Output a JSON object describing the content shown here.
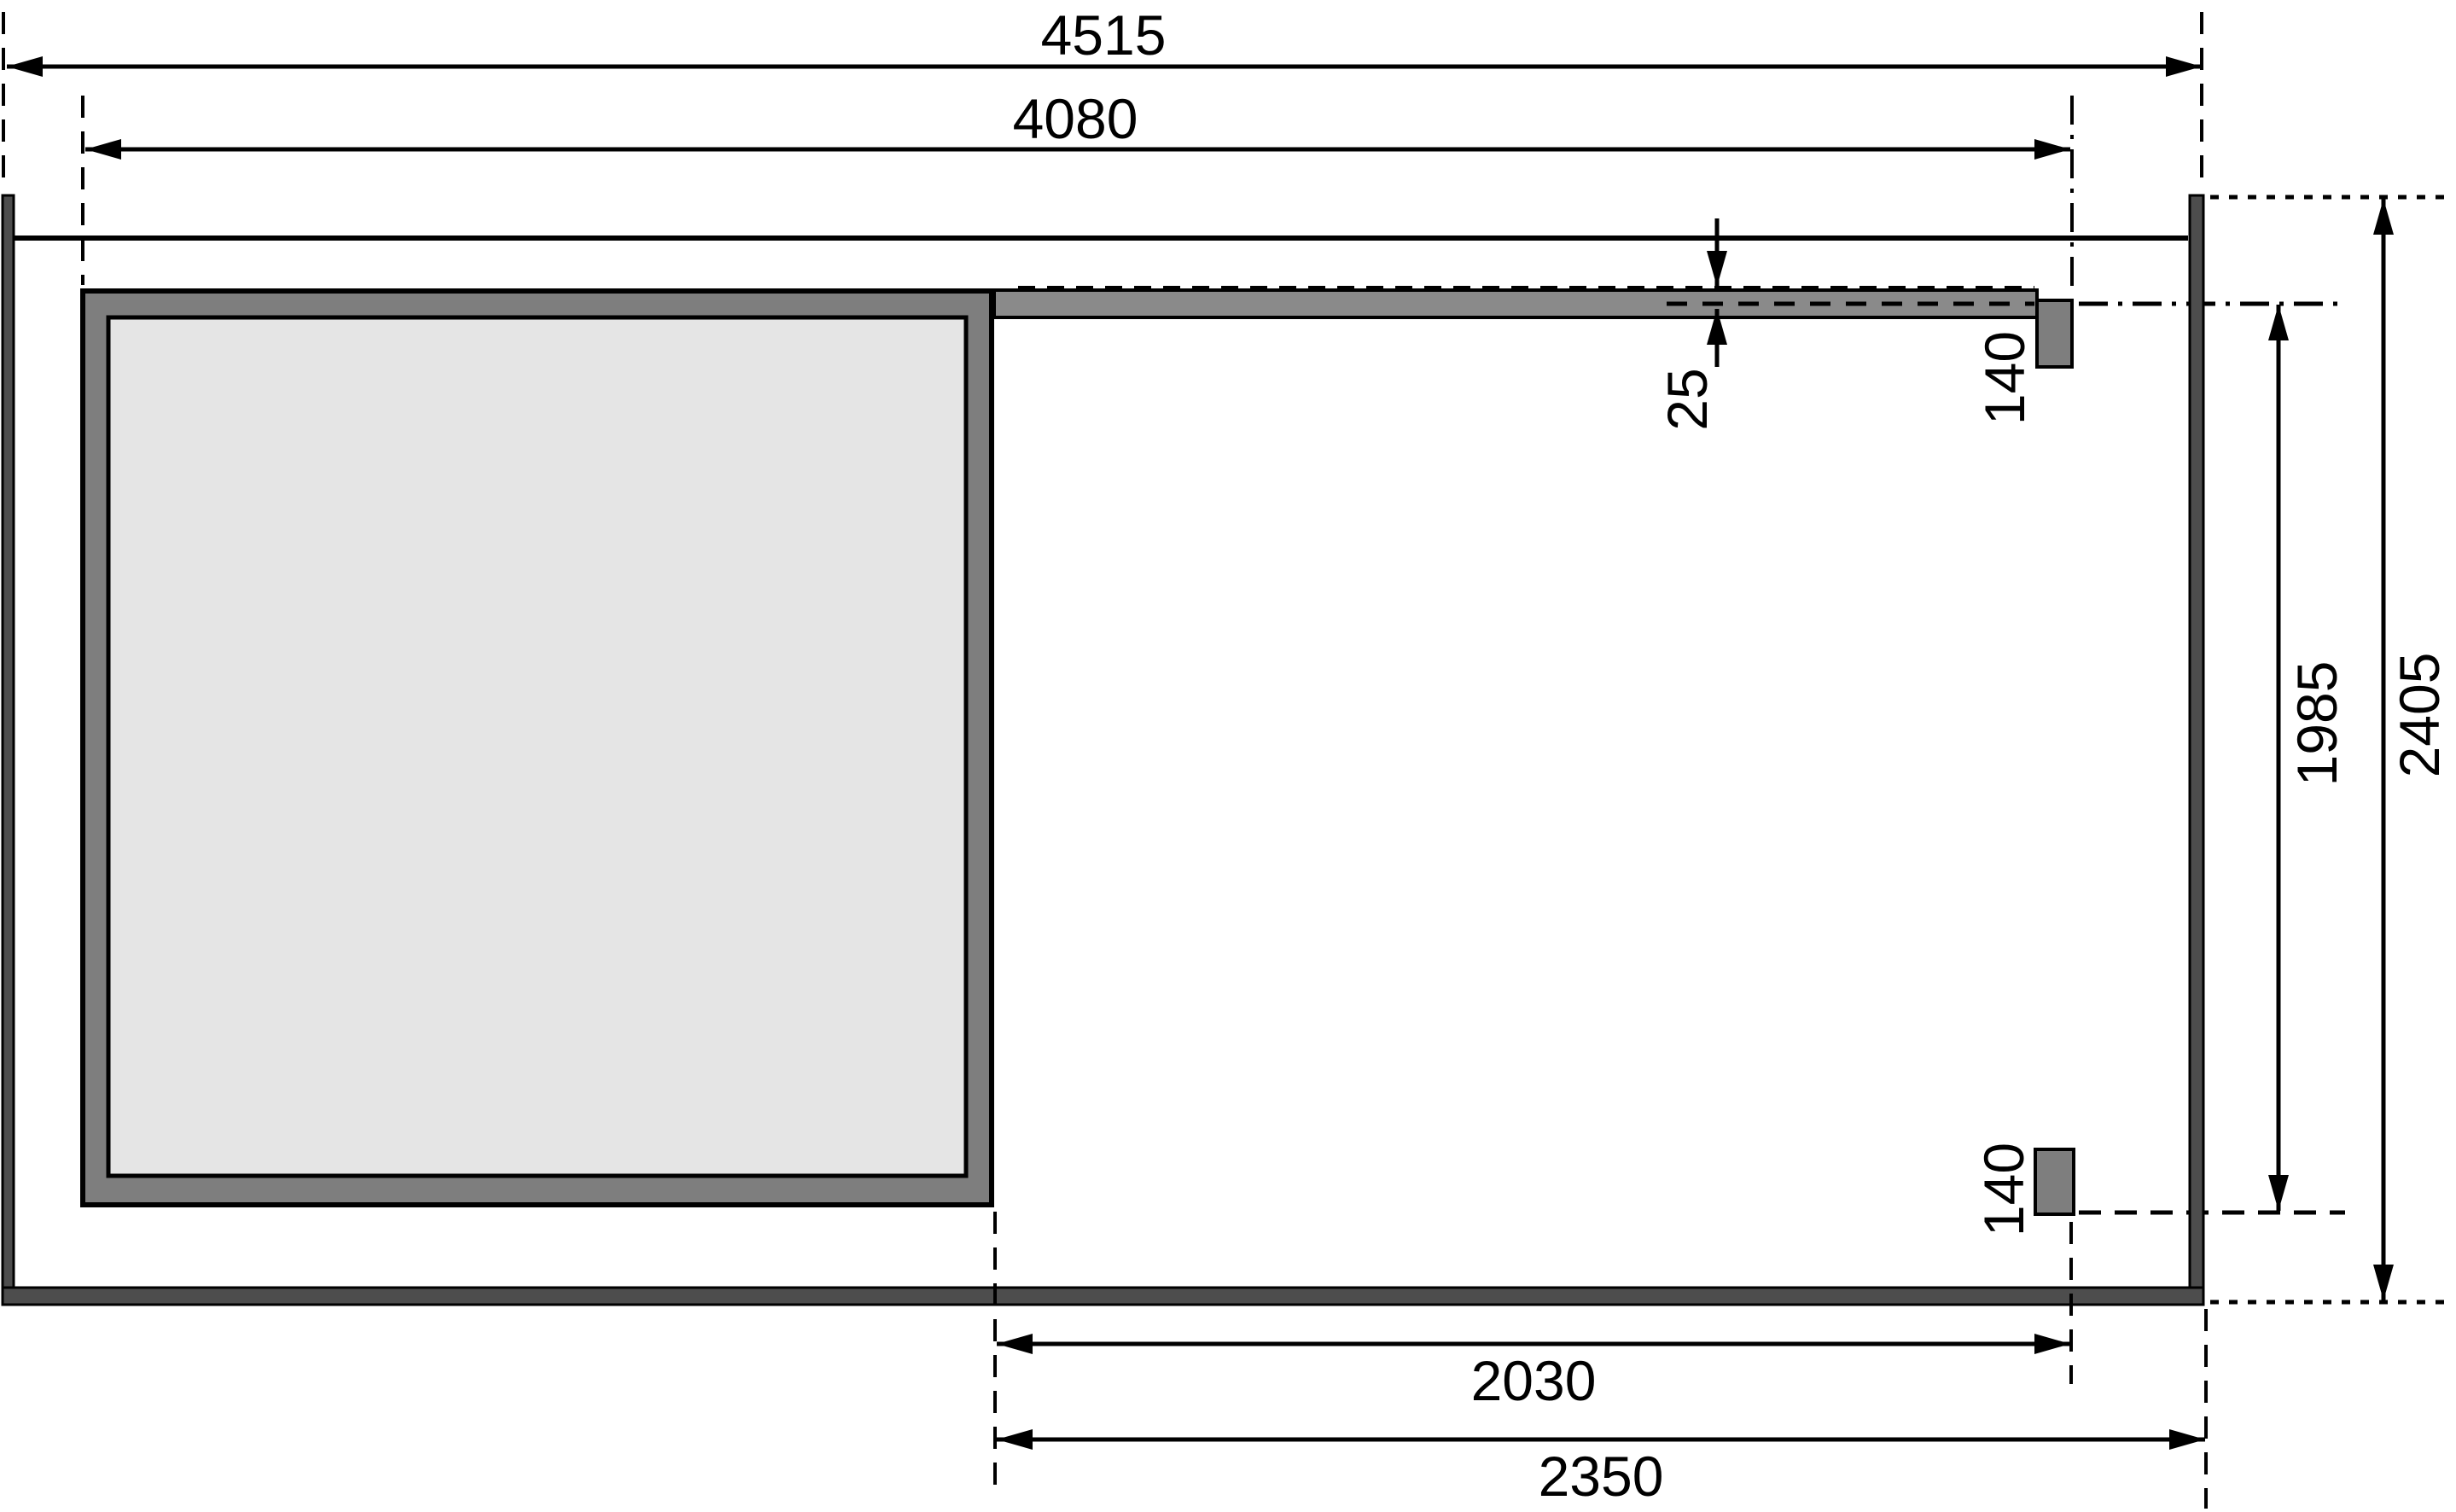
{
  "plan": {
    "title": "Shed floor plan with side canopy - dimensioned drawing",
    "dims": {
      "total_width": "4515",
      "shed_plus_canopy_width": "4080",
      "roof_board_thickness": "25",
      "post_depth_top": "140",
      "post_depth_bottom": "140",
      "post_outer_span": "1985",
      "total_depth": "2405",
      "canopy_clear_width": "2030",
      "canopy_width": "2350"
    },
    "colors": {
      "background": "#ffffff",
      "line": "#000000",
      "frame_wall": "#4d4d4d",
      "shed_wall": "#7e7e7e",
      "floor": "#e5e5e5",
      "canopy_beam": "#8a8a8a",
      "post": "#7e7e7e"
    }
  }
}
